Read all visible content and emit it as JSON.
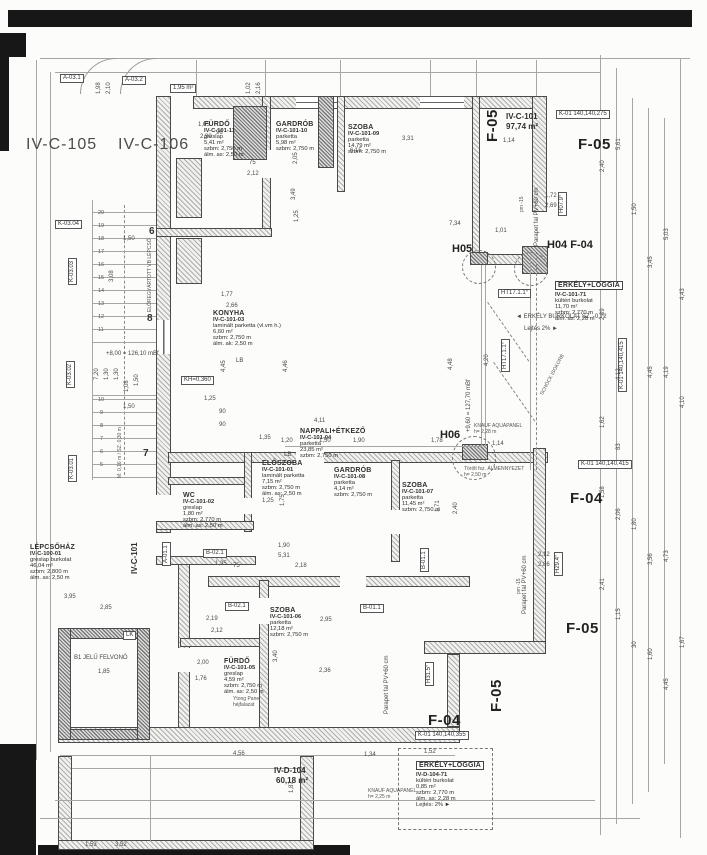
{
  "sheet": {
    "width": 707,
    "height": 855,
    "background": "#fcfcfa",
    "ink": "#3a3a3a",
    "type": "scanned architectural floor plan"
  },
  "rooms": [
    {
      "name": "FÜRDŐ",
      "code": "IV-C-101-11",
      "lines": [
        "greslap",
        "5,41 m²",
        "szbm: 2,750 m",
        "álm. as: 2,50 m"
      ],
      "x": 204,
      "y": 121
    },
    {
      "name": "GARDRÓB",
      "code": "IV-C-101-10",
      "lines": [
        "parketta",
        "5,98 m²",
        "szbm: 2,750 m"
      ],
      "x": 276,
      "y": 121
    },
    {
      "name": "SZOBA",
      "code": "IV-C-101-09",
      "lines": [
        "parketta",
        "14,79 m²",
        "szbm: 2,750 m"
      ],
      "x": 348,
      "y": 124
    },
    {
      "name": "KONYHA",
      "code": "IV-C-101-03",
      "lines": [
        "laminált parketta (vl.vm h.)",
        "6,60 m²",
        "szbm: 2,750 m",
        "álm. ak: 2,50 m"
      ],
      "x": 213,
      "y": 310
    },
    {
      "name": "NAPPALI+ÉTKEZŐ",
      "code": "IV-C-101-04",
      "lines": [
        "parketta",
        "23,85 m²",
        "szbm: 2,750 m"
      ],
      "x": 300,
      "y": 428
    },
    {
      "name": "ELŐSZOBA",
      "code": "IV-C-101-01",
      "lines": [
        "laminált parketta",
        "7,15 m²",
        "szbm: 2,750 m",
        "álm. as: 2,50 m"
      ],
      "x": 262,
      "y": 460
    },
    {
      "name": "GARDRÓB",
      "code": "IV-C-101-08",
      "lines": [
        "parketta",
        "4,14 m²",
        "szbm: 2,750 m"
      ],
      "x": 334,
      "y": 467
    },
    {
      "name": "SZOBA",
      "code": "IV-C-101-07",
      "lines": [
        "parketta",
        "11,45 m²",
        "szbm: 2,750 m"
      ],
      "x": 402,
      "y": 482
    },
    {
      "name": "WC",
      "code": "IV-C-101-02",
      "lines": [
        "greslap",
        "1,80 m²",
        "szbm: 2,770 m",
        "álm. as: 2,50 m"
      ],
      "x": 183,
      "y": 492
    },
    {
      "name": "LÉPCSŐHÁZ",
      "code": "IV-C-100-01",
      "lines": [
        "greslap burkolat",
        "46,04 m²",
        "szbm: 2,800 m",
        "álm. as: 2,50 m"
      ],
      "x": 30,
      "y": 544
    },
    {
      "name": "SZOBA",
      "code": "IV-C-101-06",
      "lines": [
        "parketta",
        "12,18 m²",
        "szbm: 2,750 m"
      ],
      "x": 270,
      "y": 607
    },
    {
      "name": "FÜRDŐ",
      "code": "IV-C-101-05",
      "lines": [
        "greslap",
        "4,59 m²",
        "szbm: 2,750 m",
        "álm. as: 2,50 m"
      ],
      "x": 224,
      "y": 658
    },
    {
      "name": "ERKÉLY+LOGGIA",
      "code": "IV-C-101-71",
      "lines": [
        "kültéri burkolat",
        "11,70 m²",
        "szbm: 2,770 m",
        "álm. as: 2,28 m"
      ],
      "x": 555,
      "y": 274,
      "boxed": true
    },
    {
      "name": "ERKÉLY+LOGGIA",
      "code": "IV-D-104-71",
      "lines": [
        "kültéri burkolat",
        "0,85 m²",
        "szbm: 2,770 m",
        "álm. as: 2,28 m",
        "Lejtés: 2%  ►"
      ],
      "x": 416,
      "y": 754,
      "boxed": true
    }
  ],
  "labels": {
    "nb": [
      {
        "t": "IV-C-105",
        "x": 26,
        "y": 136
      },
      {
        "t": "IV-C-106",
        "x": 118,
        "y": 136
      }
    ],
    "fac1": [
      {
        "t": "F-05",
        "x": 578,
        "y": 136
      },
      {
        "t": "F-05",
        "x": 484,
        "y": 142,
        "r": 1
      },
      {
        "t": "F-04",
        "x": 570,
        "y": 490
      },
      {
        "t": "F-05",
        "x": 566,
        "y": 620
      },
      {
        "t": "F-05",
        "x": 488,
        "y": 712,
        "r": 1
      },
      {
        "t": "F-04",
        "x": 428,
        "y": 712
      }
    ],
    "joint": [
      {
        "t": "H05",
        "x": 452,
        "y": 243
      },
      {
        "t": "H04  F-04",
        "x": 547,
        "y": 239
      },
      {
        "t": "H06",
        "x": 440,
        "y": 429
      }
    ],
    "area": [
      {
        "t": "IV-C-101",
        "x": 506,
        "y": 112
      },
      {
        "t": "97,74 m²",
        "x": 506,
        "y": 122
      },
      {
        "t": "IV-D-104",
        "x": 274,
        "y": 766
      },
      {
        "t": "60,18 m²",
        "x": 276,
        "y": 776
      },
      {
        "t": "IV-C-101",
        "x": 130,
        "y": 574,
        "r": 1
      }
    ],
    "box": [
      {
        "t": "K-01 140,140,275",
        "x": 556,
        "y": 110
      },
      {
        "t": "K-01 140,140,415",
        "x": 578,
        "y": 460
      },
      {
        "t": "K-01 140,140,415",
        "x": 618,
        "y": 392,
        "r": 1
      },
      {
        "t": "K-01 140,140,355",
        "x": 415,
        "y": 731
      },
      {
        "t": "K-03.04",
        "x": 55,
        "y": 220
      },
      {
        "t": "K-03.03",
        "x": 68,
        "y": 285,
        "r": 1
      },
      {
        "t": "K-03.02",
        "x": 66,
        "y": 388,
        "r": 1
      },
      {
        "t": "K-03.01",
        "x": 68,
        "y": 482,
        "r": 1
      },
      {
        "t": "A-03.1",
        "x": 60,
        "y": 74
      },
      {
        "t": "A-03.2",
        "x": 122,
        "y": 76
      },
      {
        "t": "A-01.1",
        "x": 162,
        "y": 566,
        "r": 1
      },
      {
        "t": "B-02.1",
        "x": 203,
        "y": 549
      },
      {
        "t": "B-02.1",
        "x": 225,
        "y": 602
      },
      {
        "t": "B-01.1",
        "x": 360,
        "y": 604
      },
      {
        "t": "B-01.1",
        "x": 420,
        "y": 572,
        "r": 1
      },
      {
        "t": "LK",
        "x": 123,
        "y": 631
      },
      {
        "t": "KH=0,360",
        "x": 181,
        "y": 376
      },
      {
        "t": "1,95 m²",
        "x": 170,
        "y": 84
      },
      {
        "t": "HT17.1.1°",
        "x": 498,
        "y": 289
      },
      {
        "t": "HT17.1.1°",
        "x": 501,
        "y": 372,
        "r": 1
      },
      {
        "t": "H07.9°",
        "x": 558,
        "y": 216,
        "r": 1
      },
      {
        "t": "H29.4°",
        "x": 554,
        "y": 576,
        "r": 1
      },
      {
        "t": "H31.5°",
        "x": 425,
        "y": 686,
        "r": 1
      }
    ],
    "tiny": [
      {
        "t": "◄ ERKÉLY BURKOLAT SZ. -0,72",
        "x": 516,
        "y": 314
      },
      {
        "t": "Lejtés 2% ►",
        "x": 524,
        "y": 326
      },
      {
        "t": "+8,00 = 126,10 mBf",
        "x": 106,
        "y": 351
      },
      {
        "t": "+9,60 = 127,70 mBf",
        "x": 466,
        "y": 432,
        "r": 1
      },
      {
        "t": "Parapet fal PV+60 cm",
        "x": 534,
        "y": 246,
        "r": 1
      },
      {
        "t": "Parapet fal PV+60 cm",
        "x": 522,
        "y": 614,
        "r": 1
      },
      {
        "t": "Parapet fal PV+60 cm",
        "x": 384,
        "y": 714,
        "r": 1
      },
      {
        "t": "B1 JELŰ FELVONÓ",
        "x": 74,
        "y": 655
      },
      {
        "t": "1,85",
        "x": 98,
        "y": 669
      },
      {
        "t": "LB",
        "x": 236,
        "y": 358
      },
      {
        "t": "LB",
        "x": 284,
        "y": 452
      }
    ],
    "t5": [
      {
        "t": "pm -15",
        "x": 520,
        "y": 212,
        "r": 1
      },
      {
        "t": "pm -15",
        "x": 517,
        "y": 594,
        "r": 1
      },
      {
        "t": "KNAUF AQUAPANEL",
        "x": 474,
        "y": 424
      },
      {
        "t": "h= 2,28 m",
        "x": 474,
        "y": 430
      },
      {
        "t": "KNAUF AQUAPANEL",
        "x": 368,
        "y": 789
      },
      {
        "t": "h= 2,25 m",
        "x": 368,
        "y": 795
      },
      {
        "t": "Ytong Panel",
        "x": 233,
        "y": 697
      },
      {
        "t": "héjfalazat",
        "x": 233,
        "y": 703
      },
      {
        "t": "Törölt fsz. ÁLMENNYEZET",
        "x": 464,
        "y": 467
      },
      {
        "t": "h= 2,50 m",
        "x": 464,
        "y": 473
      },
      {
        "t": "M: 0,16 m / SZ: 0,30 m",
        "x": 118,
        "y": 478,
        "r": 1
      },
      {
        "t": "ELŐREGYÁRTOTT VB LÉPCSŐ",
        "x": 148,
        "y": 312,
        "r": 1
      },
      {
        "t": "SCHÖCK ISOKORB",
        "x": 540,
        "y": 394,
        "d": 1
      }
    ],
    "grid": [
      {
        "t": "6",
        "x": 149,
        "y": 226
      },
      {
        "t": "8",
        "x": 147,
        "y": 313
      },
      {
        "t": "7",
        "x": 143,
        "y": 448
      }
    ],
    "step": [
      {
        "t": "20",
        "x": 98,
        "y": 210
      },
      {
        "t": "19",
        "x": 98,
        "y": 223
      },
      {
        "t": "18",
        "x": 98,
        "y": 236
      },
      {
        "t": "17",
        "x": 98,
        "y": 249
      },
      {
        "t": "16",
        "x": 98,
        "y": 262
      },
      {
        "t": "15",
        "x": 98,
        "y": 275
      },
      {
        "t": "14",
        "x": 98,
        "y": 288
      },
      {
        "t": "13",
        "x": 98,
        "y": 301
      },
      {
        "t": "12",
        "x": 98,
        "y": 314
      },
      {
        "t": "11",
        "x": 98,
        "y": 327
      },
      {
        "t": "10",
        "x": 98,
        "y": 397
      },
      {
        "t": "9",
        "x": 100,
        "y": 410
      },
      {
        "t": "8",
        "x": 100,
        "y": 423
      },
      {
        "t": "7",
        "x": 100,
        "y": 436
      },
      {
        "t": "6",
        "x": 100,
        "y": 449
      },
      {
        "t": "5",
        "x": 100,
        "y": 462
      }
    ],
    "dim": [
      {
        "t": "1,65",
        "x": 198,
        "y": 122
      },
      {
        "t": "2,90",
        "x": 200,
        "y": 134
      },
      {
        "t": "96",
        "x": 216,
        "y": 130
      },
      {
        "t": "2,12",
        "x": 247,
        "y": 171
      },
      {
        "t": "75",
        "x": 249,
        "y": 160
      },
      {
        "t": "2,05",
        "x": 293,
        "y": 164,
        "r": 1
      },
      {
        "t": "3,49",
        "x": 291,
        "y": 200,
        "r": 1
      },
      {
        "t": "1,25",
        "x": 294,
        "y": 222,
        "r": 1
      },
      {
        "t": "3,31",
        "x": 402,
        "y": 136
      },
      {
        "t": "6,15",
        "x": 350,
        "y": 148
      },
      {
        "t": "1,14",
        "x": 503,
        "y": 138
      },
      {
        "t": "7,34",
        "x": 449,
        "y": 221
      },
      {
        "t": "1,01",
        "x": 495,
        "y": 228
      },
      {
        "t": "1,72",
        "x": 545,
        "y": 193
      },
      {
        "t": "2,69",
        "x": 545,
        "y": 203
      },
      {
        "t": "1,77",
        "x": 221,
        "y": 292
      },
      {
        "t": "2,66",
        "x": 226,
        "y": 303
      },
      {
        "t": "4,45",
        "x": 221,
        "y": 372,
        "r": 1
      },
      {
        "t": "4,46",
        "x": 283,
        "y": 372,
        "r": 1
      },
      {
        "t": "1,25",
        "x": 204,
        "y": 396
      },
      {
        "t": "90",
        "x": 219,
        "y": 409
      },
      {
        "t": "90",
        "x": 219,
        "y": 422
      },
      {
        "t": "1,35",
        "x": 259,
        "y": 435
      },
      {
        "t": "1,20",
        "x": 281,
        "y": 438
      },
      {
        "t": "4,11",
        "x": 314,
        "y": 418
      },
      {
        "t": "1,50",
        "x": 319,
        "y": 438
      },
      {
        "t": "1,90",
        "x": 353,
        "y": 438
      },
      {
        "t": "1,78",
        "x": 431,
        "y": 438
      },
      {
        "t": "4,48",
        "x": 448,
        "y": 370,
        "r": 1
      },
      {
        "t": "4,20",
        "x": 484,
        "y": 366,
        "r": 1
      },
      {
        "t": "1,14",
        "x": 492,
        "y": 441
      },
      {
        "t": "1,25",
        "x": 262,
        "y": 498
      },
      {
        "t": "1,75",
        "x": 280,
        "y": 506,
        "r": 1
      },
      {
        "t": "5,31",
        "x": 278,
        "y": 553
      },
      {
        "t": "1,90",
        "x": 278,
        "y": 543
      },
      {
        "t": "2,18",
        "x": 295,
        "y": 563
      },
      {
        "t": "75",
        "x": 233,
        "y": 563
      },
      {
        "t": "1,35",
        "x": 215,
        "y": 561
      },
      {
        "t": "1,71",
        "x": 435,
        "y": 512,
        "r": 1
      },
      {
        "t": "2,40",
        "x": 453,
        "y": 514,
        "r": 1
      },
      {
        "t": "2,19",
        "x": 206,
        "y": 616
      },
      {
        "t": "2,12",
        "x": 211,
        "y": 628
      },
      {
        "t": "2,95",
        "x": 320,
        "y": 617
      },
      {
        "t": "2,36",
        "x": 319,
        "y": 668
      },
      {
        "t": "3,40",
        "x": 273,
        "y": 662,
        "r": 1
      },
      {
        "t": "2,00",
        "x": 197,
        "y": 660
      },
      {
        "t": "1,76",
        "x": 195,
        "y": 676
      },
      {
        "t": "3,95",
        "x": 64,
        "y": 594
      },
      {
        "t": "2,85",
        "x": 100,
        "y": 605
      },
      {
        "t": "1,50",
        "x": 123,
        "y": 236
      },
      {
        "t": "1,50",
        "x": 123,
        "y": 404
      },
      {
        "t": "3,08",
        "x": 109,
        "y": 282,
        "r": 1
      },
      {
        "t": "7,20",
        "x": 94,
        "y": 380,
        "r": 1
      },
      {
        "t": "1,30",
        "x": 104,
        "y": 380,
        "r": 1
      },
      {
        "t": "1,30",
        "x": 114,
        "y": 380,
        "r": 1
      },
      {
        "t": "1,08",
        "x": 124,
        "y": 392,
        "r": 1
      },
      {
        "t": "1,50",
        "x": 134,
        "y": 386,
        "r": 1
      },
      {
        "t": "1,02",
        "x": 246,
        "y": 94,
        "r": 1
      },
      {
        "t": "2,16",
        "x": 256,
        "y": 94,
        "r": 1
      },
      {
        "t": "1,98",
        "x": 96,
        "y": 94,
        "r": 1
      },
      {
        "t": "2,10",
        "x": 106,
        "y": 94,
        "r": 1
      },
      {
        "t": "4,56",
        "x": 233,
        "y": 751
      },
      {
        "t": "1,34",
        "x": 364,
        "y": 752
      },
      {
        "t": "1,52",
        "x": 424,
        "y": 749
      },
      {
        "t": "1,87",
        "x": 289,
        "y": 793,
        "r": 1
      },
      {
        "t": "1,53",
        "x": 85,
        "y": 842
      },
      {
        "t": "3,52",
        "x": 115,
        "y": 842
      },
      {
        "t": "2,12",
        "x": 538,
        "y": 552
      },
      {
        "t": "2,86",
        "x": 538,
        "y": 562
      },
      {
        "t": "2,40",
        "x": 600,
        "y": 172,
        "r": 1
      },
      {
        "t": "5,61",
        "x": 616,
        "y": 150,
        "r": 1
      },
      {
        "t": "1,50",
        "x": 632,
        "y": 215,
        "r": 1
      },
      {
        "t": "3,45",
        "x": 648,
        "y": 268,
        "r": 1
      },
      {
        "t": "5,03",
        "x": 664,
        "y": 240,
        "r": 1
      },
      {
        "t": "2,09",
        "x": 600,
        "y": 320,
        "r": 1
      },
      {
        "t": "4,12",
        "x": 616,
        "y": 380,
        "r": 1
      },
      {
        "t": "4,45",
        "x": 648,
        "y": 378,
        "r": 1
      },
      {
        "t": "4,19",
        "x": 664,
        "y": 378,
        "r": 1
      },
      {
        "t": "4,43",
        "x": 680,
        "y": 300,
        "r": 1
      },
      {
        "t": "1,62",
        "x": 600,
        "y": 428,
        "r": 1
      },
      {
        "t": "83",
        "x": 616,
        "y": 450,
        "r": 1
      },
      {
        "t": "1,58",
        "x": 600,
        "y": 498,
        "r": 1
      },
      {
        "t": "2,06",
        "x": 616,
        "y": 520,
        "r": 1
      },
      {
        "t": "1,80",
        "x": 632,
        "y": 530,
        "r": 1
      },
      {
        "t": "3,56",
        "x": 648,
        "y": 565,
        "r": 1
      },
      {
        "t": "4,73",
        "x": 664,
        "y": 562,
        "r": 1
      },
      {
        "t": "4,10",
        "x": 680,
        "y": 408,
        "r": 1
      },
      {
        "t": "2,41",
        "x": 600,
        "y": 590,
        "r": 1
      },
      {
        "t": "1,15",
        "x": 616,
        "y": 620,
        "r": 1
      },
      {
        "t": "30",
        "x": 632,
        "y": 648,
        "r": 1
      },
      {
        "t": "1,60",
        "x": 648,
        "y": 660,
        "r": 1
      },
      {
        "t": "4,45",
        "x": 664,
        "y": 690,
        "r": 1
      },
      {
        "t": "1,67",
        "x": 680,
        "y": 648,
        "r": 1
      }
    ]
  }
}
